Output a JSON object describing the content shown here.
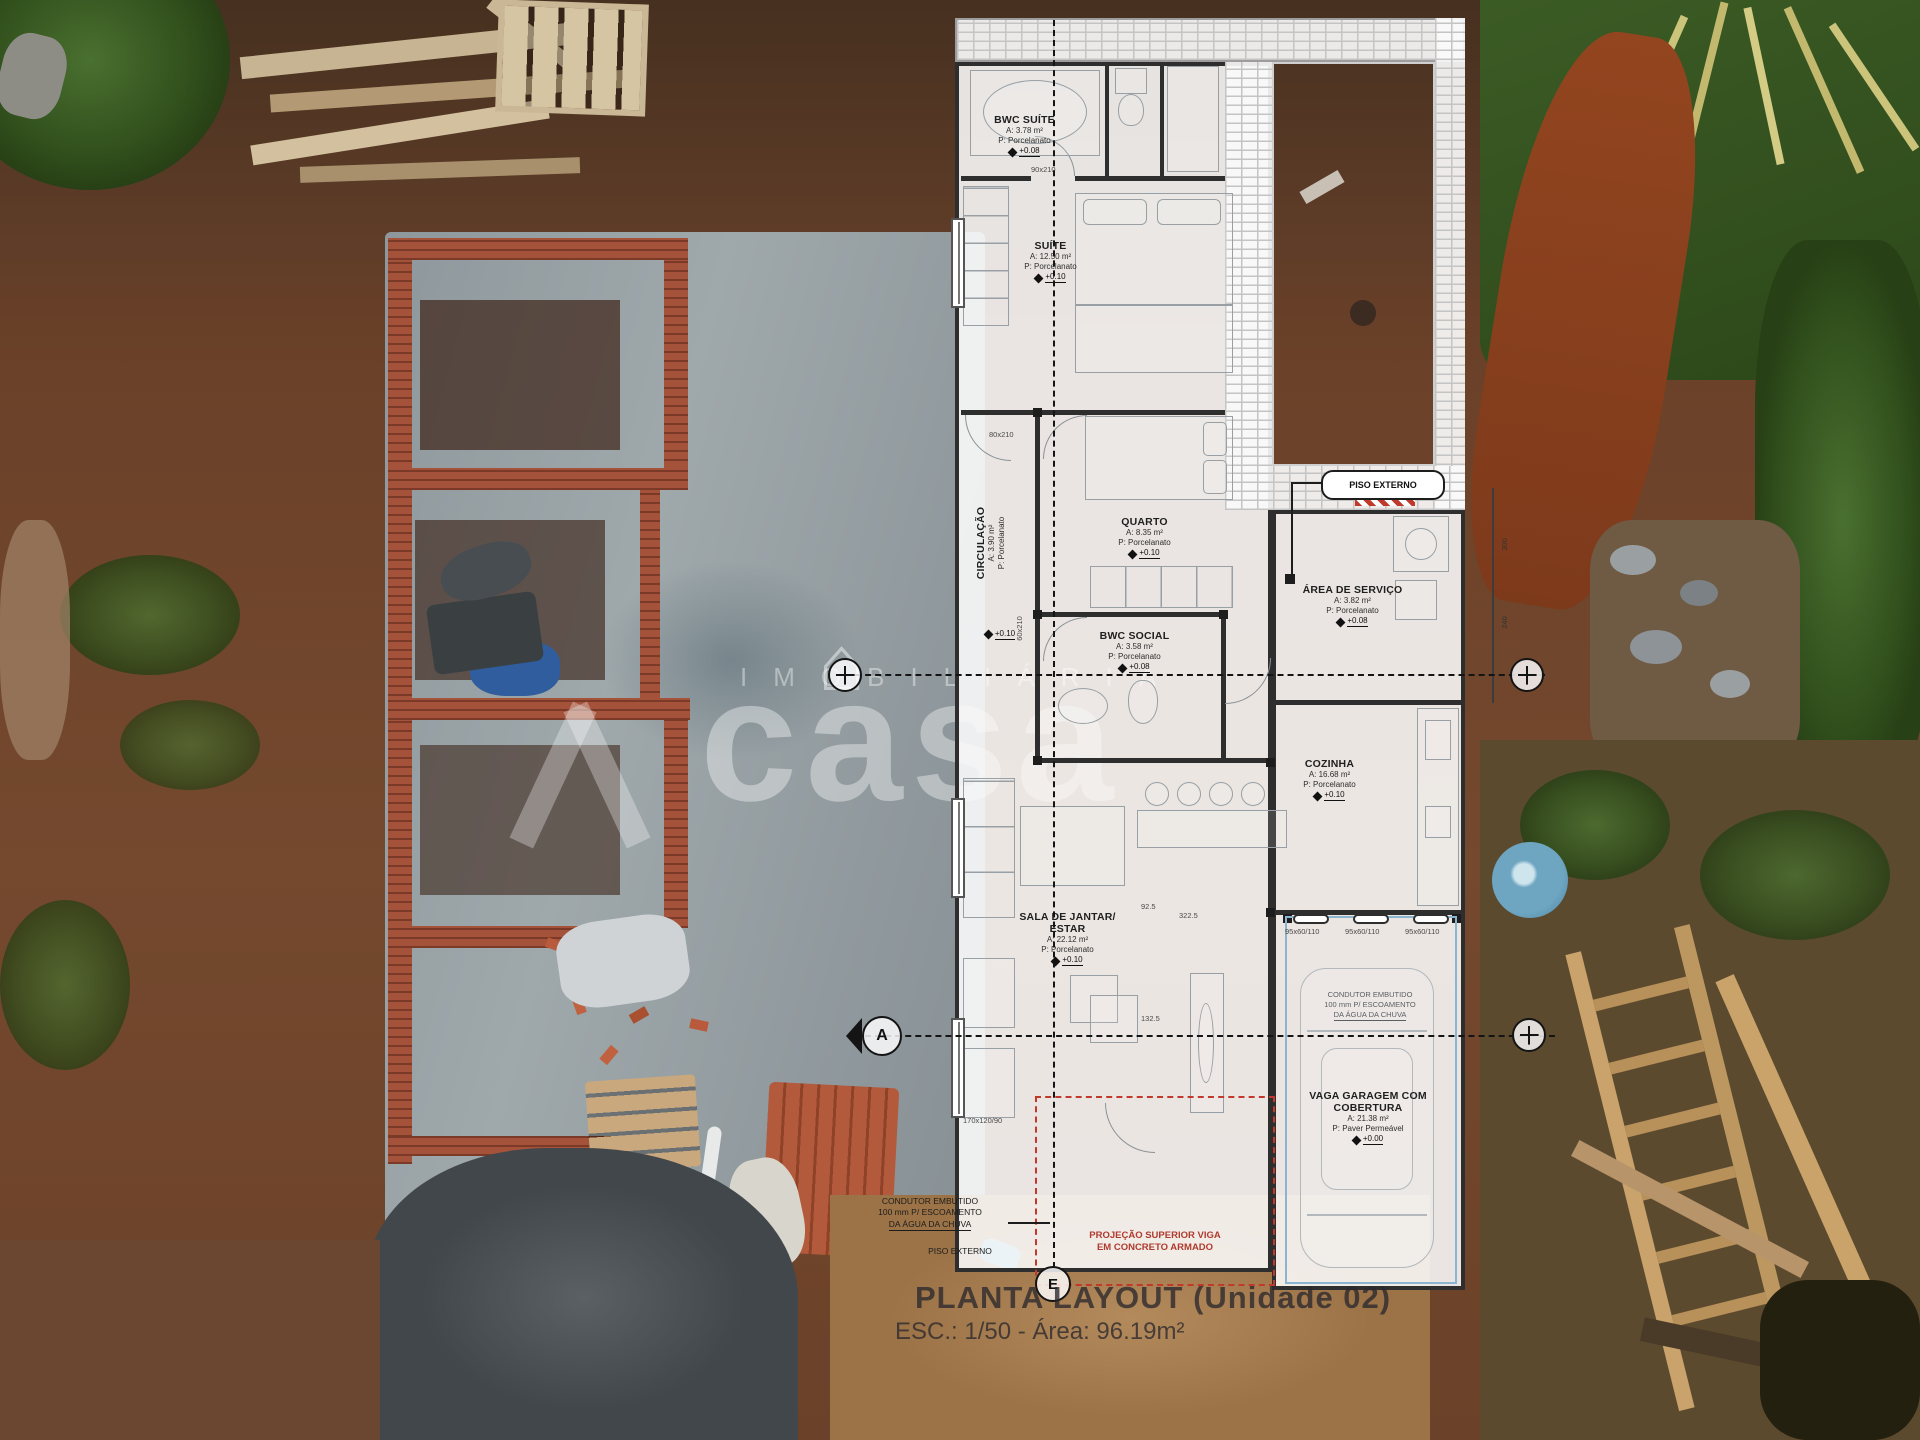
{
  "watermark": {
    "brand": "casa",
    "tagline": "IMOBILIÁRIA"
  },
  "plan": {
    "title": "PLANTA LAYOUT (Unidade 02)",
    "scale": "ESC.: 1/50 - Área: 96.19m²",
    "rooms": [
      {
        "name": "BWC SUÍTE",
        "area": "A: 3.78 m²",
        "floor": "P: Porcelanato",
        "level": "+0.08"
      },
      {
        "name": "SUÍTE",
        "area": "A: 12.50 m²",
        "floor": "P: Porcelanato",
        "level": "+0.10"
      },
      {
        "name": "QUARTO",
        "area": "A: 8.35 m²",
        "floor": "P: Porcelanato",
        "level": "+0.10"
      },
      {
        "name": "CIRCULAÇÃO",
        "area": "A: 3.90 m²",
        "floor": "P: Porcelanato",
        "level": "+0.10"
      },
      {
        "name": "BWC SOCIAL",
        "area": "A: 3.58 m²",
        "floor": "P: Porcelanato",
        "level": "+0.08"
      },
      {
        "name": "ÁREA DE SERVIÇO",
        "area": "A: 3.82 m²",
        "floor": "P: Porcelanato",
        "level": "+0.08"
      },
      {
        "name": "COZINHA",
        "area": "A: 16.68 m²",
        "floor": "P: Porcelanato",
        "level": "+0.10"
      },
      {
        "name": "SALA DE JANTAR/ ESTAR",
        "area": "A: 22.12 m²",
        "floor": "P: Porcelanato",
        "level": "+0.10"
      },
      {
        "name": "VAGA GARAGEM COM COBERTURA",
        "area": "A: 21.38 m²",
        "floor": "P: Paver Permeável",
        "level": "+0.00"
      }
    ],
    "notes": {
      "piso_externo": "PISO EXTERNO",
      "condutor_l1": "CONDUTOR EMBUTIDO",
      "condutor_l2": "100 mm P/ ESCOAMENTO",
      "condutor_l3": "DA ÁGUA DA CHUVA",
      "projecao_l1": "PROJEÇÃO SUPERIOR VIGA",
      "projecao_l2": "EM CONCRETO ARMADO"
    },
    "dimensions": {
      "door_bwc_suite": "90x210",
      "door_suite": "80x210",
      "door_bwc_social": "60x210",
      "window_garage": "95x60/110",
      "dim_a": "322.5",
      "dim_b": "92.5",
      "dim_c": "132.5",
      "window_sala": "170x120/90",
      "dim_d": "300",
      "dim_e": "240"
    },
    "section_markers": {
      "a": "A",
      "e": "E"
    }
  },
  "colors": {
    "plan_red": "#c0392b",
    "garage_blue": "#8ab4cf",
    "wall_dark": "#2e2e2e",
    "brick": "#a5523a",
    "concrete": "#98a1a4"
  }
}
